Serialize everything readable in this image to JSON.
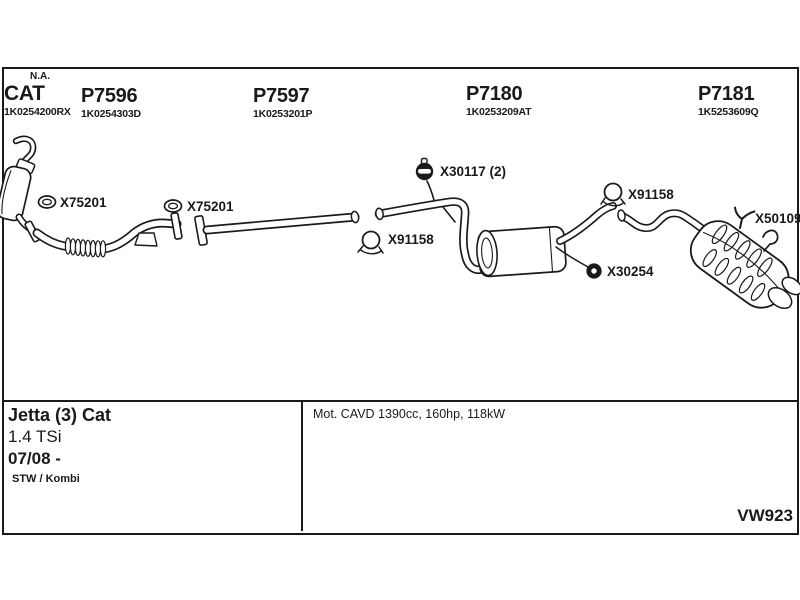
{
  "colors": {
    "ink": "#1a1a1a",
    "background": "#ffffff"
  },
  "headers": {
    "cat": {
      "flag": "N.A.",
      "title": "CAT",
      "part_number": "1K0254200RX"
    },
    "p7596": {
      "title": "P7596",
      "part_number": "1K0254303D"
    },
    "p7597": {
      "title": "P7597",
      "part_number": "1K0253201P"
    },
    "p7180": {
      "title": "P7180",
      "part_number": "1K0253209AT"
    },
    "p7181": {
      "title": "P7181",
      "part_number": "1K5253609Q"
    }
  },
  "labels": {
    "x75201_front": "X75201",
    "x75201_mid": "X75201",
    "x30117": "X30117 (2)",
    "x91158_mid": "X91158",
    "x91158_rear": "X91158",
    "x50109": "X50109",
    "x30254": "X30254"
  },
  "info": {
    "model": "Jetta (3) Cat",
    "engine": "1.4 TSi",
    "date_range": "07/08 -",
    "body_style": "STW / Kombi",
    "engine_details": "Mot. CAVD 1390cc, 160hp, 118kW",
    "diagram_code": "VW923"
  }
}
